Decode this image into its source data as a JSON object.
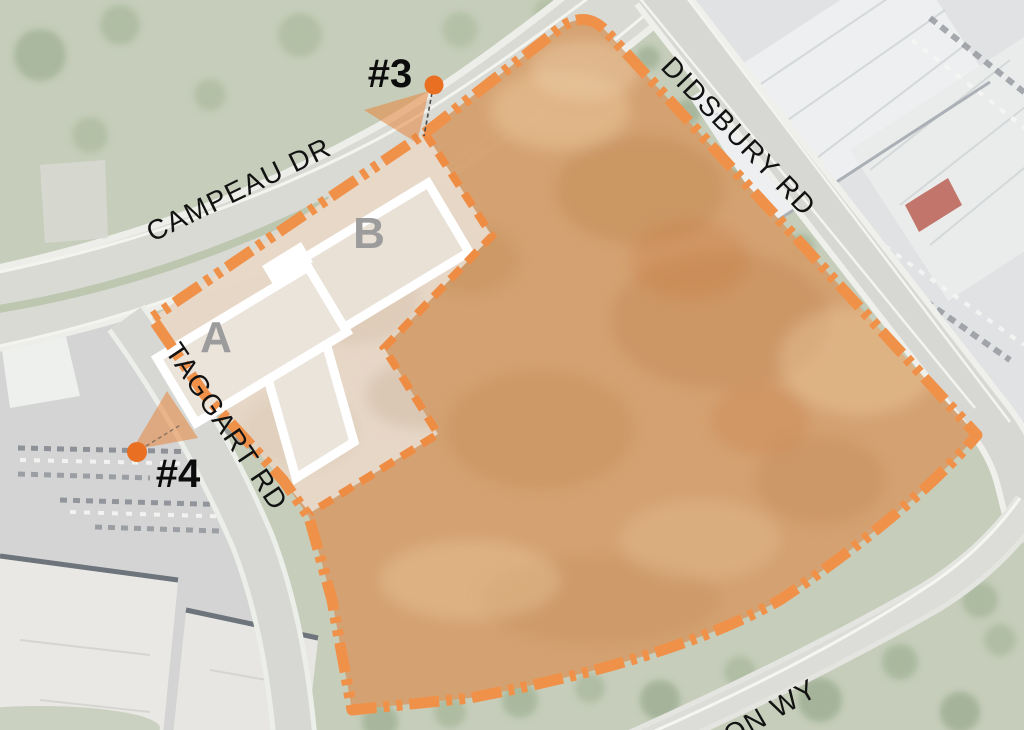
{
  "map": {
    "streets": {
      "campeau": "CAMPEAU DR",
      "didsbury": "DIDSBURY RD",
      "taggart": "TAGGART RD",
      "partial_way": "ON WY"
    },
    "markers": {
      "m3": {
        "label": "#3"
      },
      "m4": {
        "label": "#4"
      }
    },
    "buildings": {
      "a": "A",
      "b": "B"
    },
    "colors": {
      "boundary_orange": "#F0914A",
      "parcel_fill": "#D4A06E",
      "subarea_fill": "#E7DACB",
      "marker_dot": "#E96F22",
      "view_cone": "#E8853D",
      "building_fill": "#ECE4DA",
      "building_outline": "#FFFFFF",
      "building_label_gray": "#9C9C9C",
      "road_gray": "#D8D9D3",
      "grass_green": "#C6CEBB",
      "street_label_black": "#121212"
    }
  }
}
